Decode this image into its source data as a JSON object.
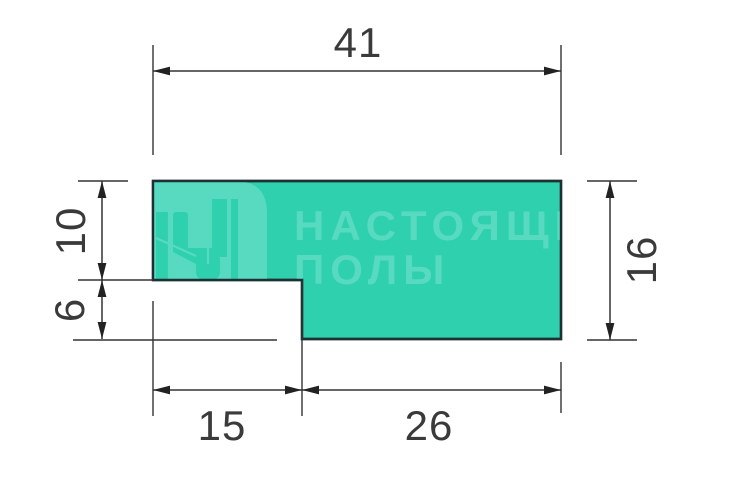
{
  "colors": {
    "background": "#ffffff",
    "profile_fill": "#2ed0ae",
    "watermark": "#57dabf",
    "outline": "#1e3132",
    "dimension_lines": "#333333",
    "dimension_text": "#3a3a3a"
  },
  "watermark": {
    "logo_icon": "flooring-planks-logo",
    "brand_line1": "НАСТОЯЩИ",
    "brand_line2": "ПОЛЫ"
  },
  "dimensions": {
    "total_width": "41",
    "upper_left_height": "10",
    "lower_left_height": "6",
    "right_height": "16",
    "notch_width": "15",
    "bottom_width": "26"
  }
}
